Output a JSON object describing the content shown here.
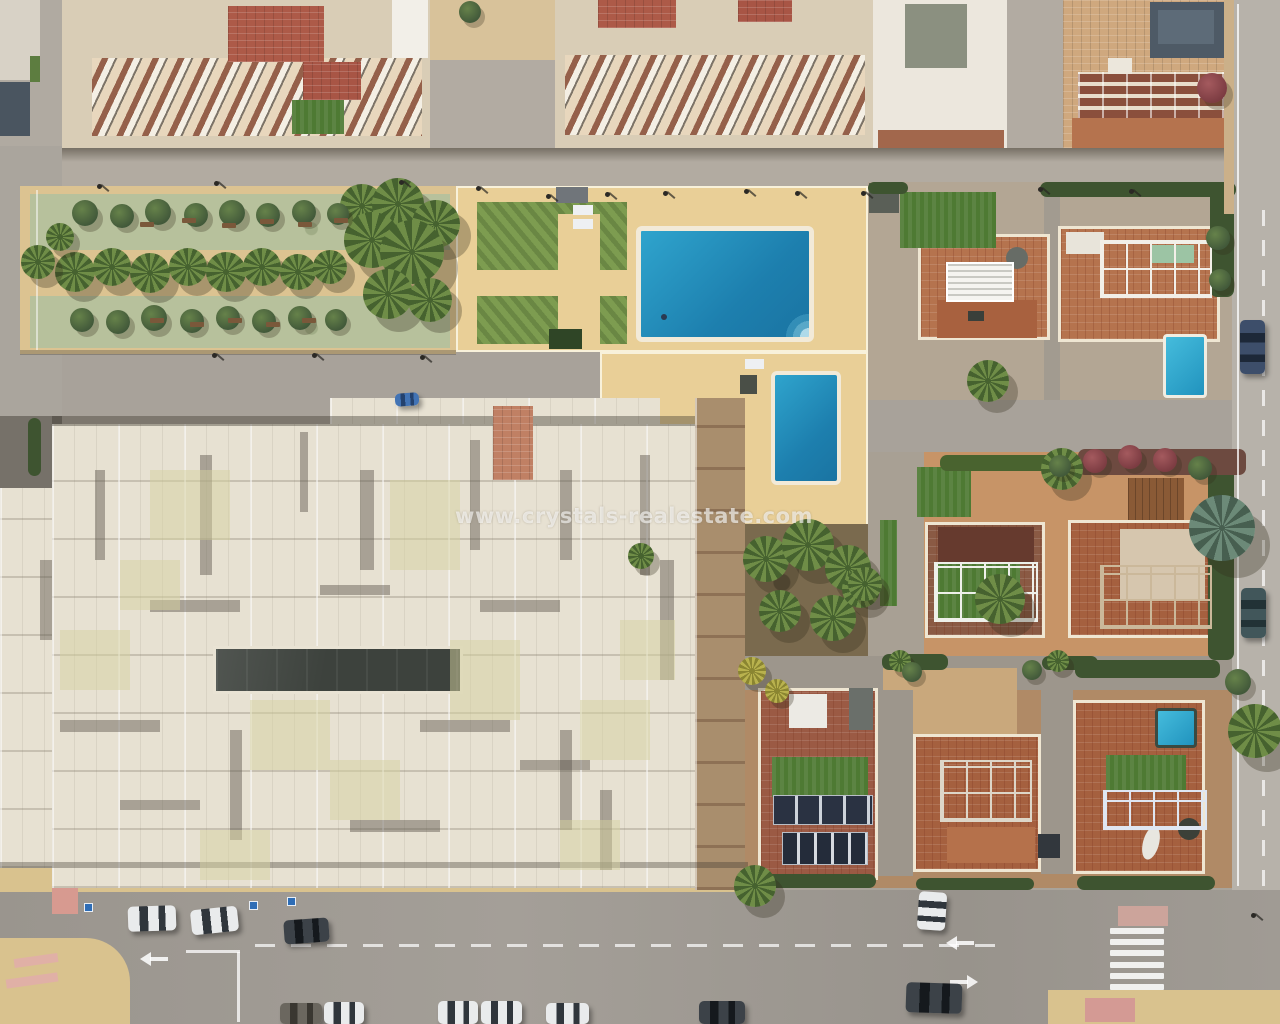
{
  "scene": {
    "description": "Top-down aerial drone photo of a coastal Spanish residential block: apartment buildings with terraced balconies at top, a palm-lined park strip, a communal pool compound with two pools, a large cream apartment roof, rows of villas with terracotta roof terraces and private pools, and streets with parked cars.",
    "watermark": {
      "text": "www.crystals-realestate.com",
      "color": "#ffffff",
      "opacity": 0.62
    },
    "palette": {
      "road": "#a9a39a",
      "sand_deck": "#e9cf97",
      "park_green": "#b7c19c",
      "lawn": "#7d9c50",
      "villa_turf": "#4e7a33",
      "pool_blue": "#1d7fae",
      "terracotta": "#b5734e",
      "cream_roof": "#e7e1d2",
      "slate": "#4e5a66"
    },
    "vegetation": {
      "palms": [
        [
          75,
          272,
          20
        ],
        [
          112,
          267,
          19
        ],
        [
          150,
          273,
          20
        ],
        [
          188,
          267,
          19
        ],
        [
          226,
          272,
          20
        ],
        [
          262,
          267,
          19
        ],
        [
          298,
          272,
          18
        ],
        [
          330,
          267,
          17
        ],
        [
          362,
          206,
          22
        ],
        [
          398,
          204,
          26
        ],
        [
          436,
          224,
          24
        ],
        [
          372,
          240,
          28
        ],
        [
          412,
          252,
          32
        ],
        [
          388,
          294,
          25
        ],
        [
          430,
          300,
          22
        ],
        [
          38,
          262,
          17
        ],
        [
          60,
          237,
          14
        ],
        [
          766,
          559,
          23
        ],
        [
          808,
          545,
          26
        ],
        [
          848,
          568,
          23
        ],
        [
          780,
          611,
          21
        ],
        [
          833,
          618,
          23
        ],
        [
          861,
          589,
          19
        ],
        [
          641,
          556,
          13
        ],
        [
          988,
          381,
          21
        ],
        [
          1062,
          469,
          21
        ],
        [
          865,
          584,
          17
        ],
        [
          1000,
          599,
          25
        ],
        [
          1222,
          528,
          33,
          "blue"
        ],
        [
          752,
          671,
          14,
          "yellow"
        ],
        [
          777,
          691,
          12,
          "yellow"
        ],
        [
          1255,
          731,
          27
        ],
        [
          900,
          661,
          11
        ],
        [
          1058,
          661,
          11
        ],
        [
          755,
          886,
          21
        ]
      ],
      "trees": [
        [
          85,
          213,
          13
        ],
        [
          122,
          216,
          12
        ],
        [
          158,
          212,
          13
        ],
        [
          196,
          215,
          12
        ],
        [
          232,
          213,
          13
        ],
        [
          268,
          215,
          12
        ],
        [
          304,
          212,
          12
        ],
        [
          338,
          214,
          11
        ],
        [
          82,
          320,
          12
        ],
        [
          118,
          322,
          12
        ],
        [
          154,
          318,
          13
        ],
        [
          192,
          321,
          12
        ],
        [
          228,
          318,
          12
        ],
        [
          264,
          321,
          12
        ],
        [
          300,
          318,
          12
        ],
        [
          336,
          320,
          11
        ],
        [
          470,
          12,
          11
        ],
        [
          1212,
          88,
          15,
          "red"
        ],
        [
          1095,
          461,
          12,
          "red"
        ],
        [
          1130,
          457,
          12,
          "red"
        ],
        [
          1165,
          460,
          12,
          "red"
        ],
        [
          1060,
          466,
          11
        ],
        [
          1200,
          468,
          12
        ],
        [
          1218,
          238,
          12
        ],
        [
          1220,
          280,
          11
        ],
        [
          1238,
          682,
          13
        ],
        [
          912,
          672,
          10
        ],
        [
          1032,
          670,
          10
        ]
      ],
      "benches": [
        [
          140,
          222
        ],
        [
          182,
          218
        ],
        [
          222,
          223
        ],
        [
          260,
          219
        ],
        [
          298,
          222
        ],
        [
          334,
          218
        ],
        [
          150,
          318
        ],
        [
          190,
          322
        ],
        [
          228,
          318
        ],
        [
          266,
          322
        ],
        [
          302,
          318
        ]
      ]
    },
    "vehicles": {
      "cars": [
        [
          128,
          906,
          48,
          25,
          "white",
          -2
        ],
        [
          191,
          908,
          47,
          25,
          "white",
          -6
        ],
        [
          284,
          919,
          45,
          24,
          "dark",
          -4
        ],
        [
          395,
          393,
          24,
          13,
          "blue",
          -4
        ],
        [
          918,
          892,
          28,
          38,
          "white",
          4
        ],
        [
          906,
          983,
          56,
          30,
          "dark",
          2
        ],
        [
          1240,
          320,
          25,
          54,
          "navy",
          0
        ],
        [
          1241,
          588,
          25,
          50,
          "teal",
          0
        ],
        [
          280,
          1003,
          42,
          21,
          "gray2",
          0
        ],
        [
          324,
          1002,
          40,
          22,
          "white",
          0
        ],
        [
          438,
          1001,
          40,
          23,
          "white",
          0
        ],
        [
          481,
          1001,
          41,
          23,
          "white",
          0
        ],
        [
          546,
          1003,
          43,
          21,
          "white",
          0
        ],
        [
          699,
          1001,
          46,
          23,
          "dark",
          0
        ]
      ]
    },
    "street_furniture": {
      "lamps": [
        [
          97,
          184
        ],
        [
          214,
          181
        ],
        [
          399,
          180
        ],
        [
          476,
          186
        ],
        [
          546,
          194
        ],
        [
          605,
          192
        ],
        [
          663,
          191
        ],
        [
          744,
          189
        ],
        [
          795,
          191
        ],
        [
          861,
          191
        ],
        [
          1038,
          187
        ],
        [
          1129,
          189
        ],
        [
          212,
          353
        ],
        [
          312,
          353
        ],
        [
          420,
          355
        ],
        [
          1251,
          913
        ]
      ],
      "signs": [
        [
          84,
          903
        ],
        [
          249,
          901
        ],
        [
          287,
          897
        ]
      ]
    },
    "markings": {
      "zebra": {
        "x": 1110,
        "y": 928,
        "w": 54,
        "h": 62,
        "n": 6
      },
      "dashes": [
        {
          "x": 255,
          "y": 944,
          "len": 745,
          "dash": 20,
          "gap": 16,
          "h": 3
        },
        {
          "x": 1262,
          "y": 210,
          "len": 670,
          "dash": 16,
          "gap": 14,
          "w": 3,
          "vert": true
        }
      ],
      "lines": [
        [
          1237,
          4,
          2,
          882
        ],
        [
          186,
          950,
          54,
          3
        ],
        [
          237,
          952,
          3,
          70
        ],
        [
          36,
          190,
          2,
          160,
          0.5
        ]
      ],
      "arrows": [
        {
          "x": 946,
          "y": 936,
          "dir": "left"
        },
        {
          "x": 948,
          "y": 975,
          "dir": "right"
        },
        {
          "x": 140,
          "y": 952,
          "dir": "left"
        }
      ]
    },
    "overlays": {
      "shadows": [
        [
          52,
          416,
          643,
          10,
          "rgba(60,54,45,.4)"
        ],
        [
          0,
          862,
          748,
          6,
          "rgba(60,54,45,.35)"
        ],
        [
          20,
          350,
          436,
          5,
          "rgba(60,54,45,.3)"
        ],
        [
          95,
          470,
          10,
          90
        ],
        [
          200,
          455,
          12,
          120
        ],
        [
          300,
          432,
          8,
          80
        ],
        [
          360,
          470,
          14,
          100
        ],
        [
          470,
          440,
          10,
          110
        ],
        [
          560,
          470,
          12,
          90
        ],
        [
          640,
          455,
          10,
          120
        ],
        [
          150,
          600,
          90,
          12
        ],
        [
          320,
          585,
          70,
          10
        ],
        [
          480,
          600,
          80,
          12
        ],
        [
          60,
          720,
          100,
          12
        ],
        [
          230,
          730,
          12,
          110
        ],
        [
          420,
          720,
          90,
          12
        ],
        [
          560,
          730,
          12,
          100
        ],
        [
          120,
          800,
          80,
          10
        ],
        [
          350,
          820,
          90,
          12
        ],
        [
          600,
          790,
          12,
          80
        ],
        [
          40,
          560,
          12,
          80
        ],
        [
          660,
          560,
          14,
          120
        ],
        [
          520,
          760,
          70,
          10
        ]
      ],
      "tints": [
        [
          150,
          470,
          80,
          70
        ],
        [
          390,
          480,
          70,
          90
        ],
        [
          60,
          630,
          70,
          60
        ],
        [
          250,
          700,
          80,
          70
        ],
        [
          450,
          640,
          70,
          80
        ],
        [
          580,
          700,
          70,
          60
        ],
        [
          120,
          560,
          60,
          50
        ],
        [
          330,
          760,
          70,
          60
        ],
        [
          560,
          820,
          60,
          50
        ],
        [
          200,
          830,
          70,
          50
        ],
        [
          620,
          620,
          55,
          60
        ]
      ],
      "turf": [
        [
          900,
          192,
          96,
          56
        ],
        [
          936,
          564,
          84,
          58
        ],
        [
          917,
          467,
          54,
          50
        ],
        [
          880,
          520,
          17,
          86
        ],
        [
          1106,
          755,
          80,
          36
        ],
        [
          772,
          757,
          96,
          40
        ],
        [
          292,
          100,
          52,
          34
        ]
      ],
      "hedges": [
        [
          1040,
          182,
          196,
          15
        ],
        [
          868,
          182,
          40,
          12
        ],
        [
          1210,
          185,
          24,
          112
        ],
        [
          1208,
          452,
          26,
          208
        ],
        [
          1078,
          449,
          168,
          26,
          "#6d4a40"
        ],
        [
          940,
          455,
          140,
          16,
          "#49632f"
        ],
        [
          882,
          654,
          66,
          16
        ],
        [
          1042,
          656,
          56,
          14
        ],
        [
          1075,
          660,
          145,
          18
        ],
        [
          748,
          874,
          128,
          14
        ],
        [
          916,
          878,
          118,
          12
        ],
        [
          1077,
          876,
          138,
          14
        ],
        [
          28,
          418,
          13,
          58
        ]
      ],
      "props": [
        [
          392,
          0,
          36,
          58,
          "#f2efe8"
        ],
        [
          228,
          6,
          96,
          56,
          "#ad5a48",
          {
            "cls": "tile"
          }
        ],
        [
          303,
          62,
          58,
          38,
          "#a85545",
          {
            "cls": "tile"
          }
        ],
        [
          598,
          0,
          78,
          28,
          "#ad5a48",
          {
            "cls": "tile"
          }
        ],
        [
          738,
          0,
          54,
          22,
          "#a85545",
          {
            "cls": "tile"
          }
        ],
        [
          905,
          4,
          62,
          64,
          "#8b9080"
        ],
        [
          878,
          130,
          126,
          18,
          "#a2674c"
        ],
        [
          1158,
          10,
          56,
          34,
          "#5d6b78"
        ],
        [
          1108,
          58,
          24,
          16,
          "#ece7dc"
        ],
        [
          0,
          0,
          40,
          80,
          "#d8d2c6"
        ],
        [
          0,
          82,
          30,
          54,
          "#4a5560"
        ],
        [
          30,
          56,
          10,
          26,
          "#5d7d40"
        ],
        [
          556,
          187,
          32,
          16,
          "#70757a"
        ],
        [
          573,
          205,
          20,
          10,
          "#eef0f2"
        ],
        [
          573,
          219,
          20,
          10,
          "#eef0f2"
        ],
        [
          745,
          359,
          19,
          10,
          "#eef0f2"
        ],
        [
          740,
          375,
          17,
          19,
          "#4a4f47"
        ],
        [
          549,
          329,
          33,
          20,
          "#2f4526"
        ],
        [
          661,
          314,
          6,
          6,
          "#2a3a52",
          {
            "br": "50%"
          }
        ],
        [
          1006,
          247,
          22,
          22,
          "#676c66",
          {
            "br": "50%"
          }
        ],
        [
          968,
          311,
          16,
          10,
          "#3a3f3a"
        ],
        [
          1152,
          245,
          42,
          18,
          "#9cc4a4"
        ],
        [
          1066,
          232,
          38,
          22,
          "#e8e4da"
        ],
        [
          493,
          406,
          40,
          74,
          "#c08064",
          {
            "cls": "tile"
          }
        ],
        [
          789,
          694,
          38,
          34,
          "#eceae4"
        ],
        [
          849,
          688,
          24,
          42,
          "#6a6f6a"
        ],
        [
          1143,
          826,
          16,
          34,
          "#e8e6e0",
          {
            "br": "50%",
            "rot": 15
          }
        ],
        [
          1178,
          818,
          22,
          22,
          "#3c4038",
          {
            "br": "50%"
          }
        ],
        [
          1038,
          834,
          22,
          24,
          "#32373d"
        ],
        [
          52,
          888,
          26,
          26,
          "#d79a90"
        ],
        [
          1085,
          998,
          50,
          24,
          "#d49a94"
        ],
        [
          1118,
          906,
          50,
          20,
          "#d8a89e",
          {
            "op": 0.8
          }
        ],
        [
          14,
          956,
          44,
          9,
          "#e0b0a6",
          {
            "rot": -8
          }
        ],
        [
          6,
          976,
          52,
          9,
          "#e0b0a6",
          {
            "rot": -8
          }
        ],
        [
          1224,
          0,
          10,
          214,
          "#cbb089"
        ]
      ],
      "railings": [
        [
          1100,
          240,
          112,
          58,
          "#f2efe8"
        ],
        [
          934,
          562,
          104,
          60,
          "#eef0ea"
        ],
        [
          1100,
          565,
          112,
          64,
          "#cbb89a"
        ],
        [
          940,
          760,
          92,
          62,
          "#ddd6c8"
        ],
        [
          1103,
          790,
          104,
          40,
          "#dfe6f2"
        ]
      ],
      "pergolas": [
        [
          946,
          262,
          68,
          40
        ]
      ],
      "solar": [
        {
          "x": 773,
          "y": 795,
          "w": 100,
          "h": 30,
          "cls": "solarA"
        },
        {
          "x": 782,
          "y": 832,
          "w": 86,
          "h": 33,
          "cls": "solarB"
        }
      ]
    }
  }
}
